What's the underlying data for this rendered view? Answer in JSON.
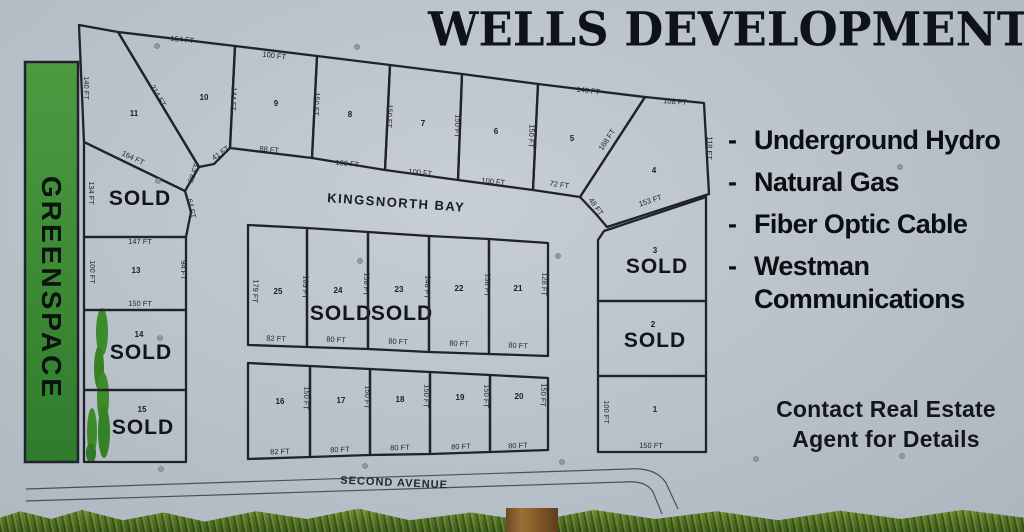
{
  "sign": {
    "title": "WELLS DEVELOPMENT",
    "background_color": "#b8c1c9",
    "line_color": "#20222e",
    "greenspace_color": "#3f8d35"
  },
  "features": {
    "bullet": "-",
    "items": [
      {
        "text": "Underground Hydro"
      },
      {
        "text": "Natural Gas"
      },
      {
        "text": "Fiber Optic Cable"
      },
      {
        "text": "Westman Communications"
      }
    ]
  },
  "contact": {
    "line1": "Contact Real Estate",
    "line2": "Agent for Details"
  },
  "map": {
    "sold_label": "SOLD",
    "greenspace_label": "GREENSPACE",
    "streets": [
      {
        "name": "KINGSNORTH BAY"
      },
      {
        "name": "SECOND AVENUE"
      }
    ],
    "lots": [
      {
        "id": "11",
        "number": "11",
        "num_pos": [
          134,
          116
        ],
        "poly": "79,25 118,32 199,167 185,191 84,142",
        "dims": [
          [
            "140 FT",
            84,
            88,
            90
          ]
        ]
      },
      {
        "id": "10",
        "number": "10",
        "num_pos": [
          204,
          100
        ],
        "poly": "118,32 235,46 230,148 214,164 199,167",
        "dims": [
          [
            "154 FT",
            182,
            42,
            6
          ],
          [
            "214 FT",
            156,
            97,
            59
          ],
          [
            "144 FT",
            231,
            99,
            93
          ],
          [
            "41 FT",
            222,
            155,
            -35
          ],
          [
            "38 FT",
            196,
            174,
            -70
          ]
        ]
      },
      {
        "id": "9",
        "number": "9",
        "num_pos": [
          276,
          106
        ],
        "poly": "235,46 317,56 312,158 230,148",
        "dims": [
          [
            "100 FT",
            274,
            58,
            7
          ],
          [
            "150 FT",
            314,
            104,
            93
          ],
          [
            "88 FT",
            269,
            152,
            6
          ]
        ]
      },
      {
        "id": "8",
        "number": "8",
        "num_pos": [
          350,
          117
        ],
        "poly": "317,56 390,65 385,170 312,158",
        "dims": [
          [
            "150 FT",
            387,
            116,
            93
          ],
          [
            "100 FT",
            347,
            166,
            6
          ]
        ]
      },
      {
        "id": "7",
        "number": "7",
        "num_pos": [
          423,
          126
        ],
        "poly": "390,65 462,74 458,180 385,170",
        "dims": [
          [
            "150 FT",
            455,
            126,
            93
          ],
          [
            "100 FT",
            420,
            175,
            6
          ]
        ]
      },
      {
        "id": "6",
        "number": "6",
        "num_pos": [
          496,
          134
        ],
        "poly": "462,74 538,84 533,190 458,180",
        "dims": [
          [
            "150 FT",
            529,
            136,
            93
          ],
          [
            "100 FT",
            493,
            184,
            6
          ]
        ]
      },
      {
        "id": "5",
        "number": "5",
        "num_pos": [
          572,
          141
        ],
        "poly": "538,84 645,97 580,197 533,190",
        "dims": [
          [
            "146 FT",
            588,
            93,
            7
          ],
          [
            "168 FT",
            609,
            141,
            -57
          ],
          [
            "72 FT",
            559,
            187,
            8
          ]
        ]
      },
      {
        "id": "4",
        "number": "4",
        "num_pos": [
          654,
          173
        ],
        "poly": "645,97 704,103 709,194 607,227 596,214 580,197",
        "dims": [
          [
            "108 FT",
            675,
            104,
            4
          ],
          [
            "118 FT",
            707,
            148,
            92
          ],
          [
            "153 FT",
            651,
            203,
            -18
          ],
          [
            "48 FT",
            594,
            208,
            55
          ]
        ]
      },
      {
        "id": "12",
        "sold": true,
        "sold_pos": [
          140,
          205
        ],
        "poly": "84,142 185,191 191,212 186,237 84,237",
        "dims": [
          [
            "164 FT",
            132,
            160,
            25
          ],
          [
            "64 FT",
            189,
            209,
            78
          ],
          [
            "134 FT",
            89,
            193,
            90
          ]
        ]
      },
      {
        "id": "13",
        "number": "13",
        "num_pos": [
          136,
          273
        ],
        "poly": "84,237 186,237 186,310 84,310",
        "dims": [
          [
            "147 FT",
            140,
            244,
            1
          ],
          [
            "100 FT",
            90,
            272,
            90
          ],
          [
            "94 FT",
            181,
            270,
            90
          ],
          [
            "150 FT",
            140,
            306,
            1
          ]
        ]
      },
      {
        "id": "14",
        "number": "14",
        "num_pos": [
          139,
          337
        ],
        "sold": true,
        "sold_pos": [
          141,
          359
        ],
        "poly": "84,310 186,310 186,390 84,390",
        "dims": []
      },
      {
        "id": "15",
        "number": "15",
        "num_pos": [
          142,
          412
        ],
        "sold": true,
        "sold_pos": [
          143,
          434
        ],
        "poly": "84,390 186,390 186,462 84,462",
        "dims": []
      },
      {
        "id": "25",
        "number": "25",
        "num_pos": [
          278,
          294
        ],
        "poly": "248,225 307,228 307,347 248,345",
        "dims": [
          [
            "179 FT",
            253,
            291,
            93
          ],
          [
            "169 FT",
            303,
            287,
            93
          ],
          [
            "82 FT",
            276,
            341,
            3
          ]
        ]
      },
      {
        "id": "24",
        "number": "24",
        "num_pos": [
          338,
          293
        ],
        "sold": true,
        "sold_pos": [
          341,
          320
        ],
        "poly": "307,228 368,232 368,349 307,347",
        "dims": [
          [
            "158 FT",
            364,
            284,
            93
          ],
          [
            "80 FT",
            336,
            342,
            3
          ]
        ]
      },
      {
        "id": "23",
        "number": "23",
        "num_pos": [
          399,
          292
        ],
        "sold": true,
        "sold_pos": [
          402,
          320
        ],
        "poly": "368,232 429,236 429,352 368,349",
        "dims": [
          [
            "148 FT",
            425,
            287,
            93
          ],
          [
            "80 FT",
            398,
            344,
            3
          ]
        ]
      },
      {
        "id": "22",
        "number": "22",
        "num_pos": [
          459,
          291
        ],
        "poly": "429,236 489,239 489,354 429,352",
        "dims": [
          [
            "138 FT",
            485,
            285,
            93
          ],
          [
            "80 FT",
            459,
            346,
            3
          ]
        ]
      },
      {
        "id": "21",
        "number": "21",
        "num_pos": [
          518,
          291
        ],
        "poly": "489,239 548,243 548,356 489,354",
        "dims": [
          [
            "128 FT",
            542,
            284,
            93
          ],
          [
            "80 FT",
            518,
            348,
            3
          ]
        ]
      },
      {
        "id": "16",
        "number": "16",
        "num_pos": [
          280,
          404
        ],
        "poly": "248,363 310,366 310,457 248,459",
        "dims": [
          [
            "150 FT",
            304,
            398,
            93
          ],
          [
            "82 FT",
            280,
            454,
            -2
          ]
        ]
      },
      {
        "id": "17",
        "number": "17",
        "num_pos": [
          341,
          403
        ],
        "poly": "310,366 370,369 370,455 310,457",
        "dims": [
          [
            "150 FT",
            365,
            397,
            93
          ],
          [
            "80 FT",
            340,
            452,
            -2
          ]
        ]
      },
      {
        "id": "18",
        "number": "18",
        "num_pos": [
          400,
          402
        ],
        "poly": "370,369 430,372 430,454 370,455",
        "dims": [
          [
            "150 FT",
            424,
            396,
            93
          ],
          [
            "80 FT",
            400,
            450,
            -2
          ]
        ]
      },
      {
        "id": "19",
        "number": "19",
        "num_pos": [
          460,
          400
        ],
        "poly": "430,372 490,375 490,452 430,454",
        "dims": [
          [
            "150 FT",
            484,
            396,
            93
          ],
          [
            "80 FT",
            461,
            449,
            -2
          ]
        ]
      },
      {
        "id": "20",
        "number": "20",
        "num_pos": [
          519,
          399
        ],
        "poly": "490,375 548,378 548,450 490,452",
        "dims": [
          [
            "150 FT",
            541,
            395,
            93
          ],
          [
            "80 FT",
            518,
            448,
            -2
          ]
        ]
      },
      {
        "id": "3",
        "number": "3",
        "num_pos": [
          655,
          253
        ],
        "sold": true,
        "sold_pos": [
          657,
          273
        ],
        "poly": "604,231 706,197 706,301 598,301 598,240",
        "dims": []
      },
      {
        "id": "2",
        "number": "2",
        "num_pos": [
          653,
          327
        ],
        "sold": true,
        "sold_pos": [
          655,
          347
        ],
        "poly": "598,301 706,301 706,376 598,376",
        "dims": []
      },
      {
        "id": "1",
        "number": "1",
        "num_pos": [
          655,
          412
        ],
        "poly": "598,376 706,376 706,452 598,452",
        "dims": [
          [
            "100 FT",
            604,
            412,
            90
          ],
          [
            "150 FT",
            651,
            448,
            1
          ]
        ]
      }
    ],
    "rivets": [
      [
        157,
        46
      ],
      [
        357,
        47
      ],
      [
        158,
        181
      ],
      [
        360,
        261
      ],
      [
        558,
        256
      ],
      [
        160,
        338
      ],
      [
        365,
        466
      ],
      [
        562,
        462
      ],
      [
        161,
        469
      ],
      [
        756,
        459
      ],
      [
        902,
        456
      ],
      [
        900,
        167
      ]
    ]
  }
}
